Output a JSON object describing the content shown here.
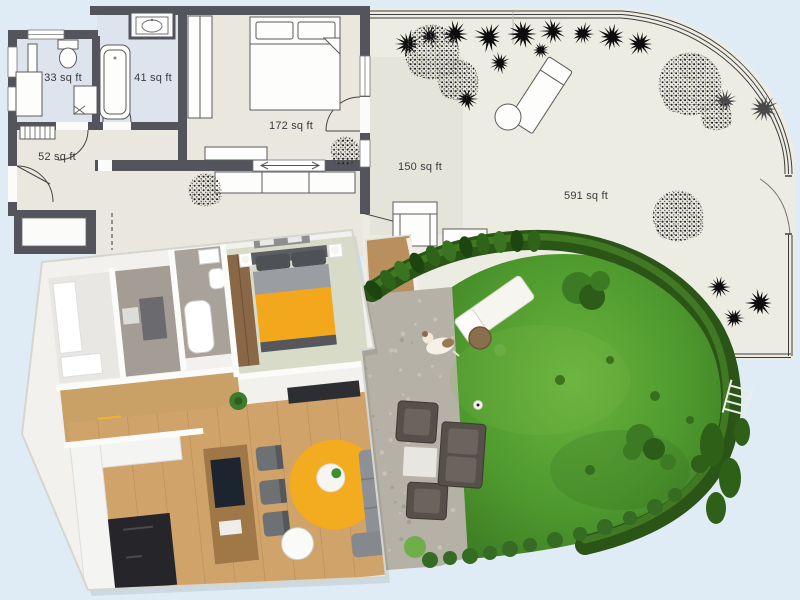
{
  "scene": {
    "description": "Apartment floor plan with garden — 2D plan on top, 3D dollhouse render overlapping below",
    "background_color": "#dfecf5"
  },
  "plan_2d": {
    "unit": "sq ft",
    "rooms": [
      {
        "id": "bathroom-small",
        "area_label": "33 sq ft"
      },
      {
        "id": "bathroom-main",
        "area_label": "41 sq ft"
      },
      {
        "id": "hallway",
        "area_label": "52 sq ft"
      },
      {
        "id": "bedroom",
        "area_label": "172 sq ft"
      },
      {
        "id": "patio",
        "area_label": "150 sq ft"
      },
      {
        "id": "garden",
        "area_label": "591 sq ft"
      }
    ],
    "colors": {
      "wall": "#54555c",
      "bathroom_floor": "#dde4ee",
      "room_floor": "#eae8de",
      "patio_floor": "#e5e4db",
      "garden_ground": "#edece3",
      "outline": "#4a4a4a",
      "plant_dark": "#0d0d0d"
    },
    "fixtures": [
      "toilet",
      "shower",
      "vanity-cabinet",
      "bathtub",
      "sink",
      "radiator",
      "double-bed",
      "wardrobe",
      "sideboard",
      "armchair",
      "outdoor-sofa",
      "garden-lounger",
      "side-table",
      "entrance-door",
      "garden-gate",
      "fence"
    ],
    "plants": [
      {
        "type": "shrub",
        "x": 408,
        "y": 44,
        "r": 13
      },
      {
        "type": "shrub",
        "x": 430,
        "y": 36,
        "r": 11
      },
      {
        "type": "shrub",
        "x": 455,
        "y": 34,
        "r": 13
      },
      {
        "type": "shrub",
        "x": 489,
        "y": 37,
        "r": 14
      },
      {
        "type": "shrub",
        "x": 523,
        "y": 34,
        "r": 14
      },
      {
        "type": "shrub",
        "x": 553,
        "y": 31,
        "r": 12
      },
      {
        "type": "shrub",
        "x": 583,
        "y": 34,
        "r": 11
      },
      {
        "type": "shrub",
        "x": 612,
        "y": 37,
        "r": 13
      },
      {
        "type": "shrub",
        "x": 640,
        "y": 44,
        "r": 12
      },
      {
        "type": "shrub",
        "x": 500,
        "y": 63,
        "r": 10
      },
      {
        "type": "shrub",
        "x": 467,
        "y": 99,
        "r": 11
      },
      {
        "type": "shrub",
        "x": 541,
        "y": 50,
        "r": 8
      },
      {
        "type": "shrub",
        "x": 725,
        "y": 101,
        "r": 11,
        "tone": "gray"
      },
      {
        "type": "shrub",
        "x": 764,
        "y": 109,
        "r": 13,
        "tone": "gray"
      },
      {
        "type": "shrub",
        "x": 719,
        "y": 287,
        "r": 11
      },
      {
        "type": "shrub",
        "x": 760,
        "y": 303,
        "r": 13
      },
      {
        "type": "shrub",
        "x": 734,
        "y": 318,
        "r": 10
      },
      {
        "type": "tree",
        "x": 432,
        "y": 52,
        "r": 27
      },
      {
        "type": "tree",
        "x": 458,
        "y": 80,
        "r": 20
      },
      {
        "type": "tree",
        "x": 690,
        "y": 84,
        "r": 31
      },
      {
        "type": "tree",
        "x": 716,
        "y": 115,
        "r": 15
      },
      {
        "type": "tree",
        "x": 678,
        "y": 216,
        "r": 25
      },
      {
        "type": "tree",
        "x": 345,
        "y": 151,
        "r": 14
      },
      {
        "type": "tree",
        "x": 205,
        "y": 190,
        "r": 16
      }
    ]
  },
  "render_3d": {
    "colors": {
      "lawn": "#54a033",
      "hedge": "#2a5517",
      "wood_floor": "#cfa369",
      "kitchen_dark": "#26262a",
      "bed_yellow": "#f2a71c",
      "rug_yellow": "#f3ab1f",
      "sofa_gray": "#8d9095",
      "tile_gray": "#a39d95",
      "patio_stone": "#b5b1a6",
      "outdoor_furniture": "#57504a",
      "shell_white": "#fbfbf9"
    },
    "objects": [
      "bed",
      "wardrobe",
      "bathtub",
      "toilet",
      "sink",
      "kitchen-island",
      "fridge",
      "dining-chairs",
      "round-table",
      "yellow-rug",
      "sofa",
      "tv-bench",
      "houseplant",
      "lawn",
      "hedge",
      "stone-patio",
      "armchairs",
      "coffee-table",
      "outdoor-sofa",
      "sun-lounger",
      "dog",
      "football",
      "garden-bushes",
      "ladder",
      "deck"
    ]
  }
}
